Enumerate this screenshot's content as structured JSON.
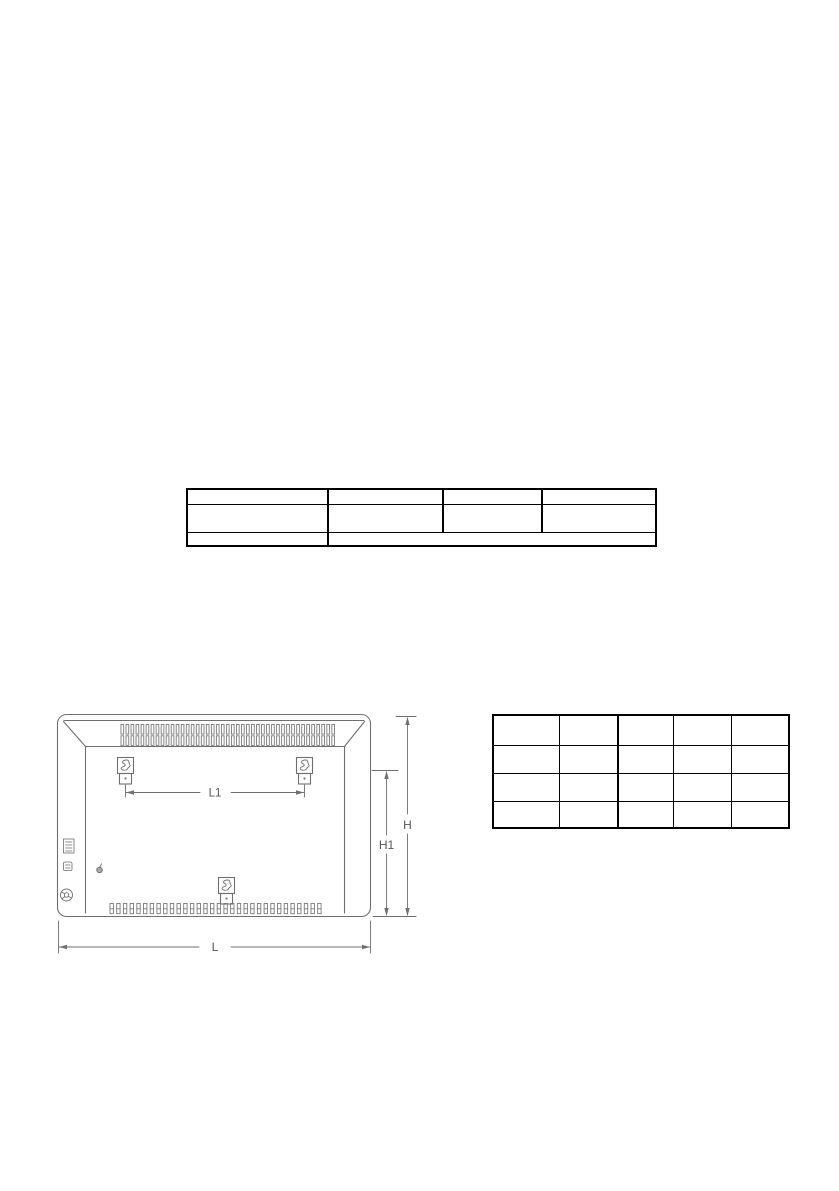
{
  "document": {
    "background": "#ffffff"
  },
  "top_table": {
    "rows": 3,
    "columns": 4,
    "merged_last_row": true,
    "cells_empty": true
  },
  "dimension_table": {
    "rows": 4,
    "columns": 5,
    "cells_empty": true
  },
  "diagram": {
    "description": "rear-view-of-panel-convector-heater-with-wall-bracket-dimensions",
    "dimension_labels": {
      "l1": "L1",
      "h": "H",
      "h1": "H1",
      "l": "L"
    },
    "colors": {
      "drawing_line": "#6f6f6f",
      "label_text": "#555555",
      "table_border": "#000000"
    }
  }
}
